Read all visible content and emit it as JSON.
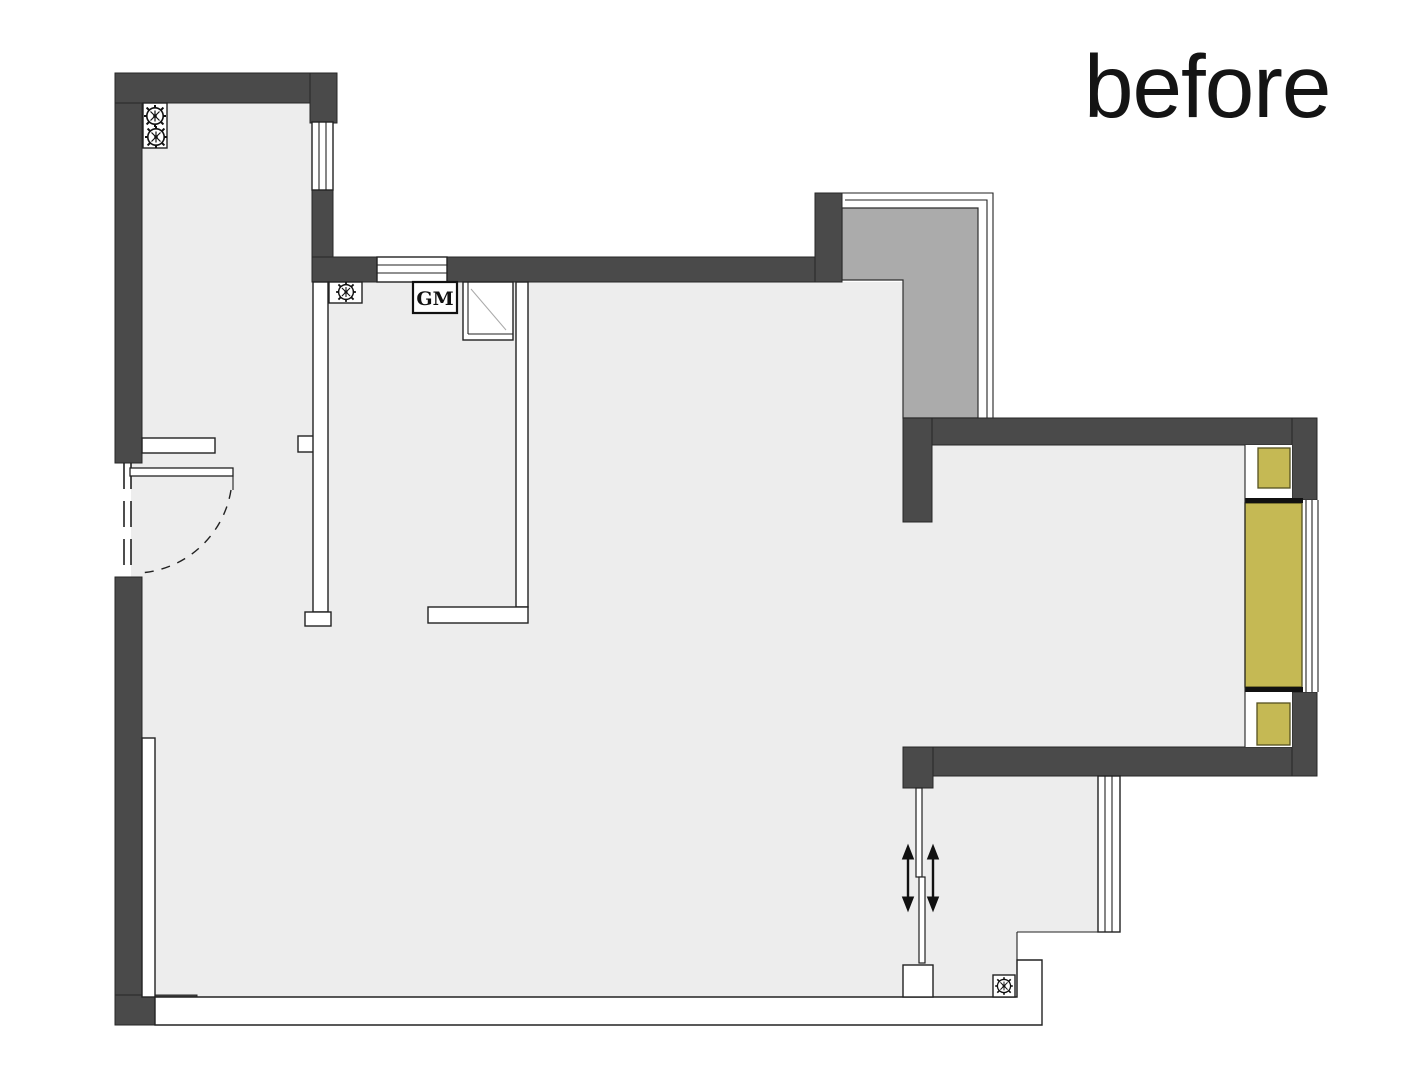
{
  "title": {
    "label": "before"
  },
  "plan": {
    "gas_meter_label": "GM",
    "colors": {
      "wall": "#4a4a4a",
      "floor": "#ededed",
      "shaft": "#ababab",
      "accent": "#c5b954",
      "line": "#222222",
      "bg": "#ffffff"
    }
  },
  "icons": {
    "pipe_riser": "gear-circle-icon",
    "floor_drain": "gear-circle-icon",
    "sliding_door_arrows": "double-vertical-arrow-icon"
  }
}
